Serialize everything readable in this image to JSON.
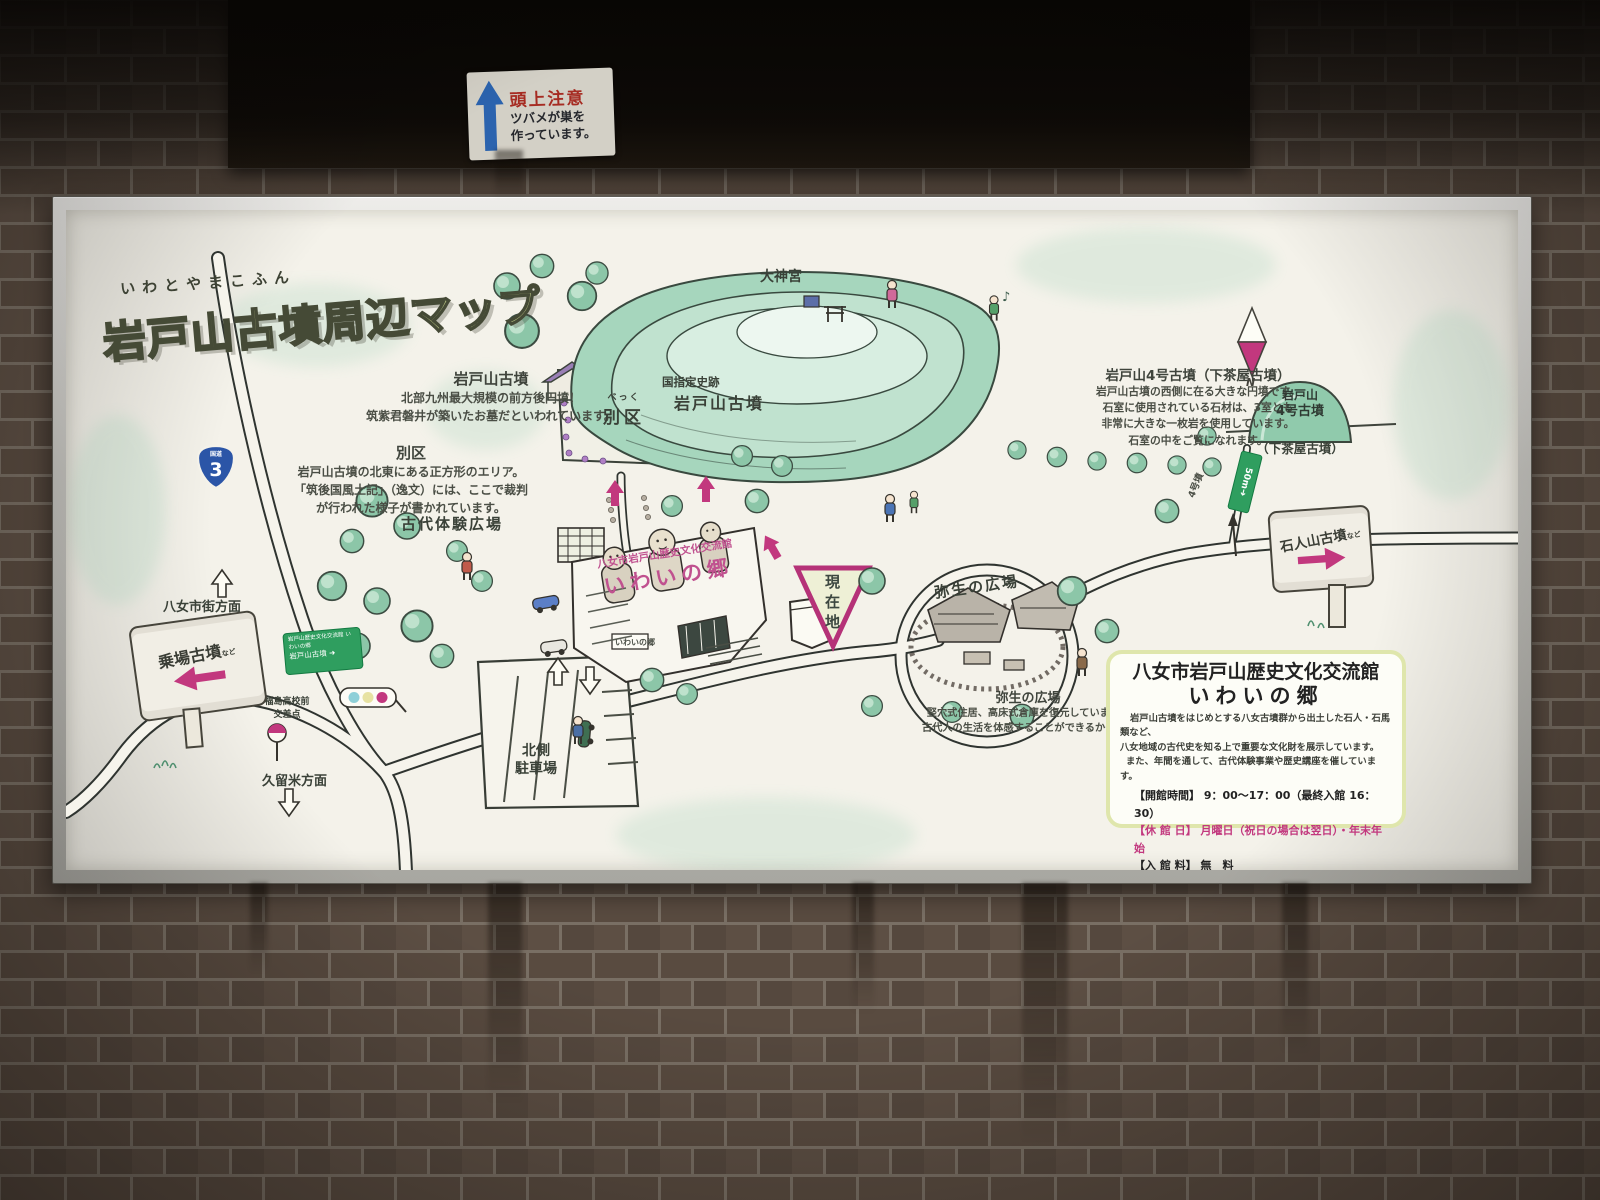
{
  "overhead": {
    "warning_title": "頭上注意",
    "warning_line1": "ツバメが巣を",
    "warning_line2": "作っています。"
  },
  "board": {
    "title": {
      "furigana": "いわとやまこふん",
      "main": "岩戸山古墳周辺マップ"
    },
    "descriptions": {
      "iwatoyama": {
        "title": "岩戸山古墳",
        "line1": "北部九州最大規模の前方後円墳！",
        "line2": "筑紫君磐井が築いたお墓だといわれています。"
      },
      "bekku": {
        "title": "別区",
        "line1": "岩戸山古墳の北東にある正方形のエリア。",
        "line2": "「筑後国風土記」（逸文）には、ここで裁判",
        "line3": "が行われた様子が書かれています。"
      },
      "yongou": {
        "title": "岩戸山4号古墳（下茶屋古墳）",
        "line1": "岩戸山古墳の西側に在る大きな円墳です。",
        "line2": "石室に使用されている石材は、3室とも",
        "line3": "非常に大きな一枚岩を使用しています。",
        "line4": "石室の中をご覧になれます。"
      },
      "yayoi": {
        "title": "弥生の広場",
        "line1": "竪穴式住居、高床式倉庫を復元しています。",
        "line2": "古代人の生活を体感することができるかも？！"
      }
    },
    "map_labels": {
      "daijingu": "大神宮",
      "kokushitei": "国指定史跡",
      "iwatoyama_kofun": "岩戸山古墳",
      "bekku_furigana": "べっく",
      "bekku": "別区",
      "kodai_taiken_hiroba": "古代体験広場",
      "yayoi_hiroba": "弥生の広場",
      "genzaichi": "現在地",
      "parking_line1": "北側",
      "parking_line2": "駐車場",
      "yame_direction": "八女市街方面",
      "kurume_direction": "久留米方面",
      "fukushima_line1": "福島高校前",
      "fukushima_line2": "交差点",
      "noriba_kofun": "乗場古墳",
      "noriba_nado": "など",
      "sekijin_kofun": "石人山古墳",
      "sekijin_nado": "など",
      "yongou_mound_line1": "岩戸山",
      "yongou_mound_line2": "4号古墳",
      "shimochaya": "（下茶屋古墳）",
      "sign_50m": "50m",
      "sign_50m_arrow": "➜",
      "yongou_fun": "4号墳",
      "compass_n": "N",
      "music_note": "♪",
      "route_label": "国道",
      "route_number": "3",
      "green_sign_line1": "岩戸山歴史文化交流館 いわいの郷",
      "green_sign_line2": "岩戸山古墳",
      "green_sign_arrow": "➜",
      "building_small_sign": "いわいの郷"
    },
    "building_label": {
      "line1": "八女市岩戸山歴史文化交流館",
      "line2": "いわいの郷"
    },
    "info_box": {
      "title_line1": "八女市岩戸山歴史文化交流館",
      "title_line2": "いわいの郷",
      "body_line1": "岩戸山古墳をはじめとする八女古墳群から出土した石人・石馬類など、",
      "body_line2": "八女地域の古代史を知る上で重要な文化財を展示しています。",
      "body_line3": "また、年間を通して、古代体験事業や歴史講座を催しています。",
      "hours_label": "【開館時間】",
      "hours_value": "9：00～17：00（最終入館 16：30）",
      "closed_label": "【休 館 日】",
      "closed_value": "月曜日（祝日の場合は翌日）・年末年始",
      "fee_label": "【入 館 料】",
      "fee_value": "無　料"
    },
    "colors": {
      "accent_magenta": "#c2387e",
      "map_green": "#8cc6a8",
      "title_green": "#c8d28e",
      "info_border": "#dfe6ac",
      "route_shield_blue": "#2b55a7",
      "sign_green": "#2f9e5f"
    }
  }
}
